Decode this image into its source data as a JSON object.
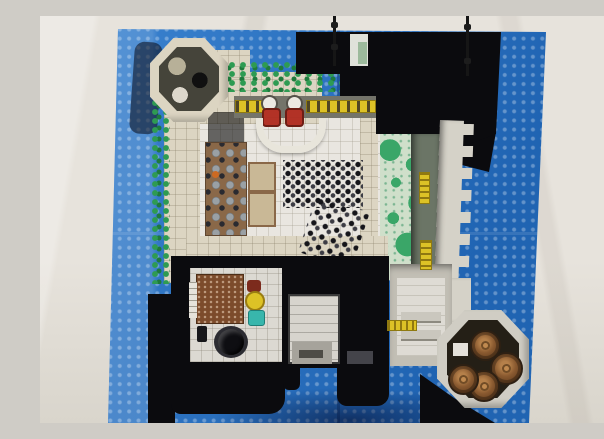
{
  "image": {
    "type": "photograph",
    "subject": "Overhead (top-down) photo of a LEGO castle model with its floors exposed, built on a blue LEGO baseplate lying on a pale fabric surface",
    "aria_label": "Top-down photograph of a LEGO castle on a blue studded baseplate: cream stone walls form a square keep with an octagonal tower at the top-left, black pyramidal roofs with two flagpoles at the top-right, a green speckled courtyard and crenellated outer wall with yellow ladders on the right, a great hall with two red thrones, yellow benches and a crowd of minifigures in the center, a brown banquet table on the left, black-walled service rooms with a wooden floor, yellow table, teal chest and black cauldron at the bottom, a gatehouse passage at bottom-center, and an octagonal corner tower full of brown barrels at the bottom-right."
  },
  "palette": {
    "fabric": "#e7e3dc",
    "fabric_shade": "#d9d5cc",
    "plate_blue": "#2677cd",
    "roof_black": "#0b0b0e",
    "wall_cream": "#dcd5c2",
    "wall_gray": "#d5d2c8",
    "floor_white": "#e9e6e0",
    "foliage_green": "#2e9b52",
    "foliage_dark": "#1e7a3c",
    "grass_pale": "#cfdfca",
    "grass_green": "#3aa668",
    "walkway": "#6b7566",
    "wood_brown": "#7c4b2b",
    "table_brown": "#8a6848",
    "barrel_brown": "#8a5a30",
    "throne_red": "#b23226",
    "accent_yellow": "#ddc226",
    "teal": "#38b6ac",
    "metal_gray": "#44444a",
    "stone_tan": "#b7b098"
  },
  "scene": {
    "objects": [
      {
        "name": "fabric-background",
        "color_ref": "fabric"
      },
      {
        "name": "lego-baseplate",
        "color_ref": "plate_blue"
      },
      {
        "name": "octagonal-tower-top-left",
        "color_ref": "wall_cream"
      },
      {
        "name": "black-roof-section",
        "color_ref": "roof_black"
      },
      {
        "name": "flagpole-left",
        "color_ref": "roof_black"
      },
      {
        "name": "flagpole-right",
        "color_ref": "roof_black"
      },
      {
        "name": "foliage-hedges",
        "color_ref": "foliage_green"
      },
      {
        "name": "grass-courtyard",
        "color_ref": "grass_green"
      },
      {
        "name": "crenellated-outer-wall",
        "color_ref": "wall_gray"
      },
      {
        "name": "wall-ladders",
        "color_ref": "accent_yellow",
        "count": 3
      },
      {
        "name": "throne-pair",
        "color_ref": "throne_red",
        "count": 2
      },
      {
        "name": "feast-benches",
        "color_ref": "accent_yellow"
      },
      {
        "name": "banquet-table",
        "color_ref": "table_brown"
      },
      {
        "name": "minifigure-crowd",
        "color_ref": "roof_black"
      },
      {
        "name": "great-hall-floor",
        "color_ref": "floor_white"
      },
      {
        "name": "service-room-wood-floor",
        "color_ref": "wood_brown"
      },
      {
        "name": "round-yellow-table",
        "color_ref": "accent_yellow"
      },
      {
        "name": "teal-chest",
        "color_ref": "teal"
      },
      {
        "name": "black-cauldron",
        "color_ref": "roof_black"
      },
      {
        "name": "gatehouse-passage",
        "color_ref": "wall_gray"
      },
      {
        "name": "barrel-tower-bottom-right",
        "color_ref": "wall_gray"
      },
      {
        "name": "barrels",
        "color_ref": "barrel_brown",
        "count": 4
      }
    ]
  }
}
